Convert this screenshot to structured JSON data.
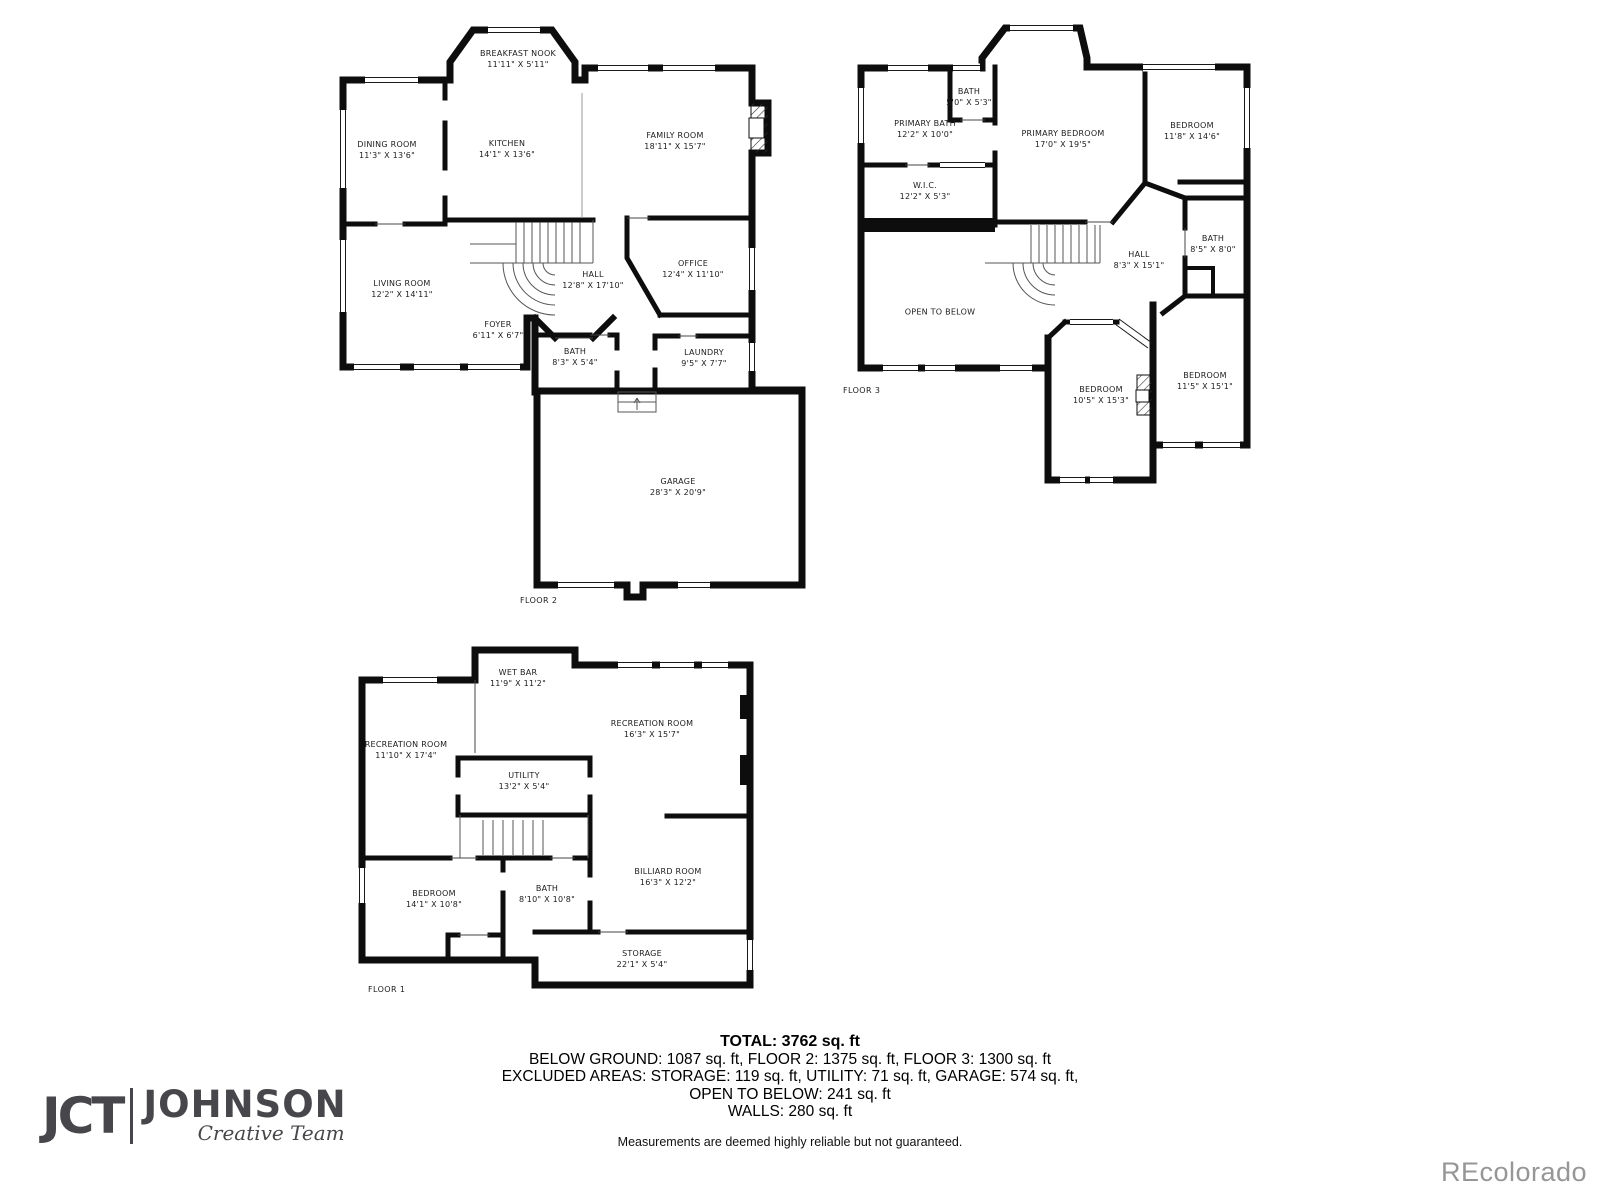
{
  "floors": [
    {
      "id": "floor-2",
      "label": "FLOOR 2",
      "rooms": [
        {
          "name": "BREAKFAST NOOK",
          "dims": "11'11\" X 5'11\"",
          "x": 188,
          "y": 42
        },
        {
          "name": "DINING ROOM",
          "dims": "11'3\" X 13'6\"",
          "x": 57,
          "y": 133
        },
        {
          "name": "KITCHEN",
          "dims": "14'1\" X 13'6\"",
          "x": 177,
          "y": 132
        },
        {
          "name": "FAMILY ROOM",
          "dims": "18'11\" X 15'7\"",
          "x": 345,
          "y": 124
        },
        {
          "name": "LIVING ROOM",
          "dims": "12'2\" X 14'11\"",
          "x": 72,
          "y": 272
        },
        {
          "name": "HALL",
          "dims": "12'8\" X 17'10\"",
          "x": 263,
          "y": 263
        },
        {
          "name": "OFFICE",
          "dims": "12'4\" X 11'10\"",
          "x": 363,
          "y": 252
        },
        {
          "name": "FOYER",
          "dims": "6'11\" X 6'7\"",
          "x": 168,
          "y": 313
        },
        {
          "name": "BATH",
          "dims": "8'3\" X 5'4\"",
          "x": 245,
          "y": 340
        },
        {
          "name": "LAUNDRY",
          "dims": "9'5\" X 7'7\"",
          "x": 374,
          "y": 341
        },
        {
          "name": "GARAGE",
          "dims": "28'3\" X 20'9\"",
          "x": 348,
          "y": 470
        }
      ]
    },
    {
      "id": "floor-3",
      "label": "FLOOR 3",
      "rooms": [
        {
          "name": "PRIMARY BATH",
          "dims": "12'2\" X 10'0\"",
          "x": 80,
          "y": 112
        },
        {
          "name": "BATH",
          "dims": "5'0\" X 5'3\"",
          "x": 124,
          "y": 80
        },
        {
          "name": "PRIMARY BEDROOM",
          "dims": "17'0\" X 19'5\"",
          "x": 218,
          "y": 122
        },
        {
          "name": "BEDROOM",
          "dims": "11'8\" X 14'6\"",
          "x": 347,
          "y": 114
        },
        {
          "name": "W.I.C.",
          "dims": "12'2\" X 5'3\"",
          "x": 80,
          "y": 174
        },
        {
          "name": "HALL",
          "dims": "8'3\" X 15'1\"",
          "x": 294,
          "y": 243
        },
        {
          "name": "BATH",
          "dims": "8'5\" X 8'0\"",
          "x": 368,
          "y": 227
        },
        {
          "name": "OPEN TO BELOW",
          "dims": "",
          "x": 95,
          "y": 295
        },
        {
          "name": "BEDROOM",
          "dims": "10'5\" X 15'3\"",
          "x": 256,
          "y": 378
        },
        {
          "name": "BEDROOM",
          "dims": "11'5\" X 15'1\"",
          "x": 360,
          "y": 364
        }
      ]
    },
    {
      "id": "floor-1",
      "label": "FLOOR 1",
      "rooms": [
        {
          "name": "WET BAR",
          "dims": "11'9\" X 11'2\"",
          "x": 168,
          "y": 44
        },
        {
          "name": "RECREATION ROOM",
          "dims": "11'10\" X 17'4\"",
          "x": 56,
          "y": 116
        },
        {
          "name": "RECREATION ROOM",
          "dims": "16'3\" X 15'7\"",
          "x": 302,
          "y": 95
        },
        {
          "name": "UTILITY",
          "dims": "13'2\" X 5'4\"",
          "x": 174,
          "y": 147
        },
        {
          "name": "BEDROOM",
          "dims": "14'1\" X 10'8\"",
          "x": 84,
          "y": 265
        },
        {
          "name": "BATH",
          "dims": "8'10\" X 10'8\"",
          "x": 197,
          "y": 260
        },
        {
          "name": "BILLIARD ROOM",
          "dims": "16'3\" X 12'2\"",
          "x": 318,
          "y": 243
        },
        {
          "name": "STORAGE",
          "dims": "22'1\" X 5'4\"",
          "x": 292,
          "y": 325
        }
      ]
    }
  ],
  "summary": {
    "total": "TOTAL: 3762 sq. ft",
    "lines": [
      "BELOW GROUND: 1087 sq. ft, FLOOR 2: 1375 sq. ft, FLOOR 3: 1300 sq. ft",
      "EXCLUDED AREAS: STORAGE: 119 sq. ft, UTILITY: 71 sq. ft, GARAGE: 574 sq. ft,",
      "OPEN TO BELOW: 241 sq. ft",
      "WALLS: 280 sq. ft"
    ]
  },
  "disclaimer": "Measurements are deemed highly reliable but not guaranteed.",
  "logo": {
    "mark": "JCT",
    "name": "JOHNSON",
    "tagline": "Creative Team"
  },
  "watermark": "REcolorado",
  "colors": {
    "wall": "#0d0d0d",
    "text": "#1c1c1c",
    "logo": "#47474b",
    "watermark": "#969696"
  }
}
